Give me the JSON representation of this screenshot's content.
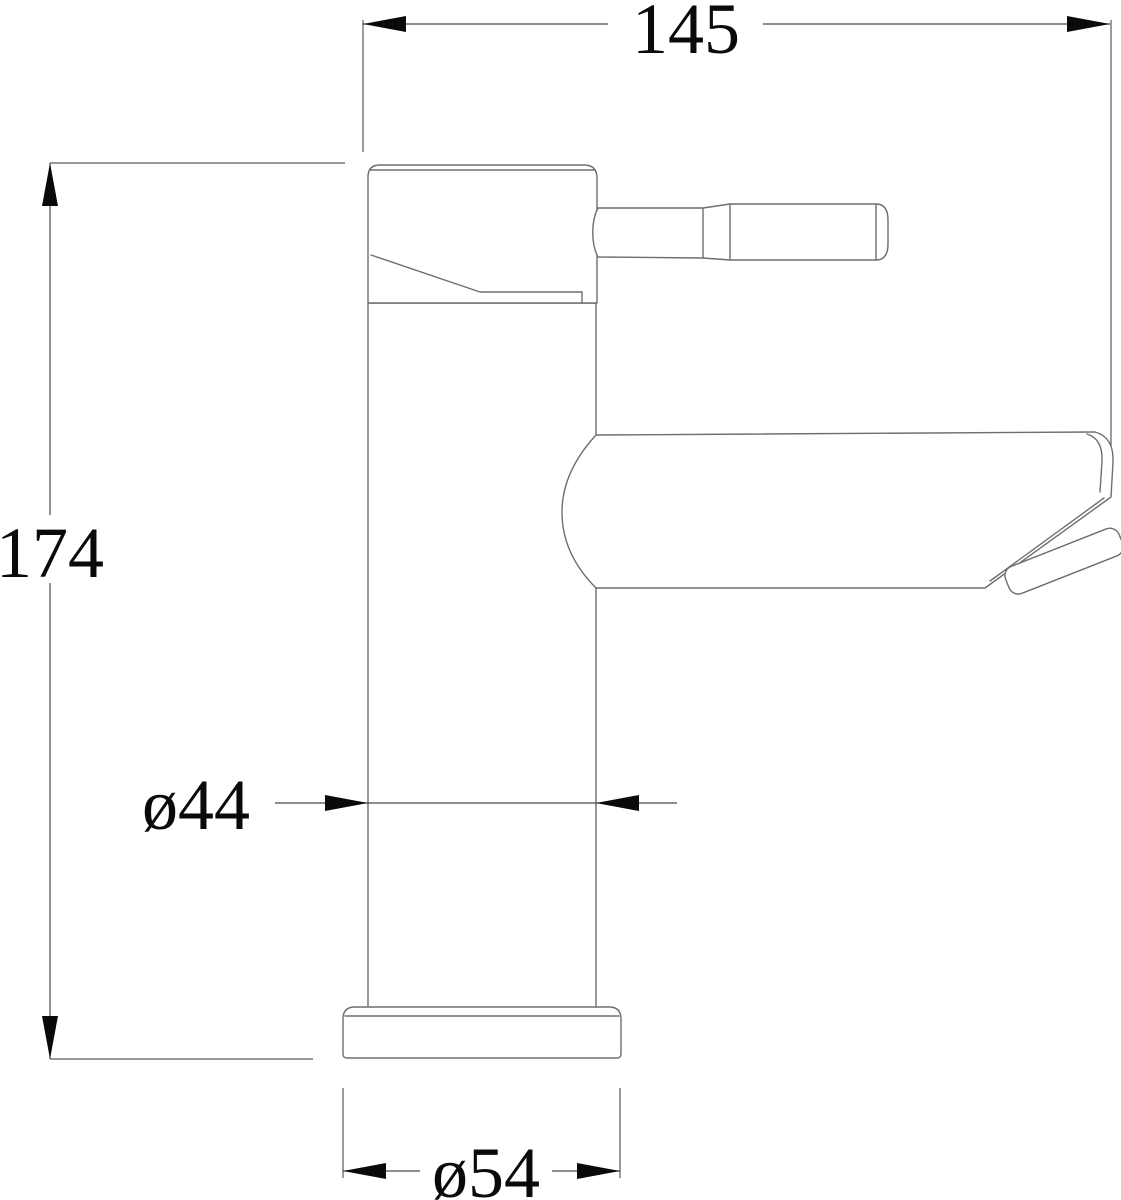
{
  "drawing": {
    "subject": "single-lever basin mixer tap side elevation with dimensions",
    "background": "#ffffff",
    "outline_color": "#6e6e6e",
    "dimension_line_color": "#4a4a4a",
    "text_color": "#0a0a0a",
    "dimensions": [
      {
        "id": "overall-width",
        "label": "145",
        "value": 145,
        "orientation": "horizontal",
        "position": "top"
      },
      {
        "id": "overall-height",
        "label": "174",
        "value": 174,
        "orientation": "vertical",
        "position": "left"
      },
      {
        "id": "body-diameter",
        "label": "ø44",
        "value": 44,
        "orientation": "horizontal",
        "position": "middle"
      },
      {
        "id": "base-diameter",
        "label": "ø54",
        "value": 54,
        "orientation": "horizontal",
        "position": "bottom"
      }
    ]
  }
}
